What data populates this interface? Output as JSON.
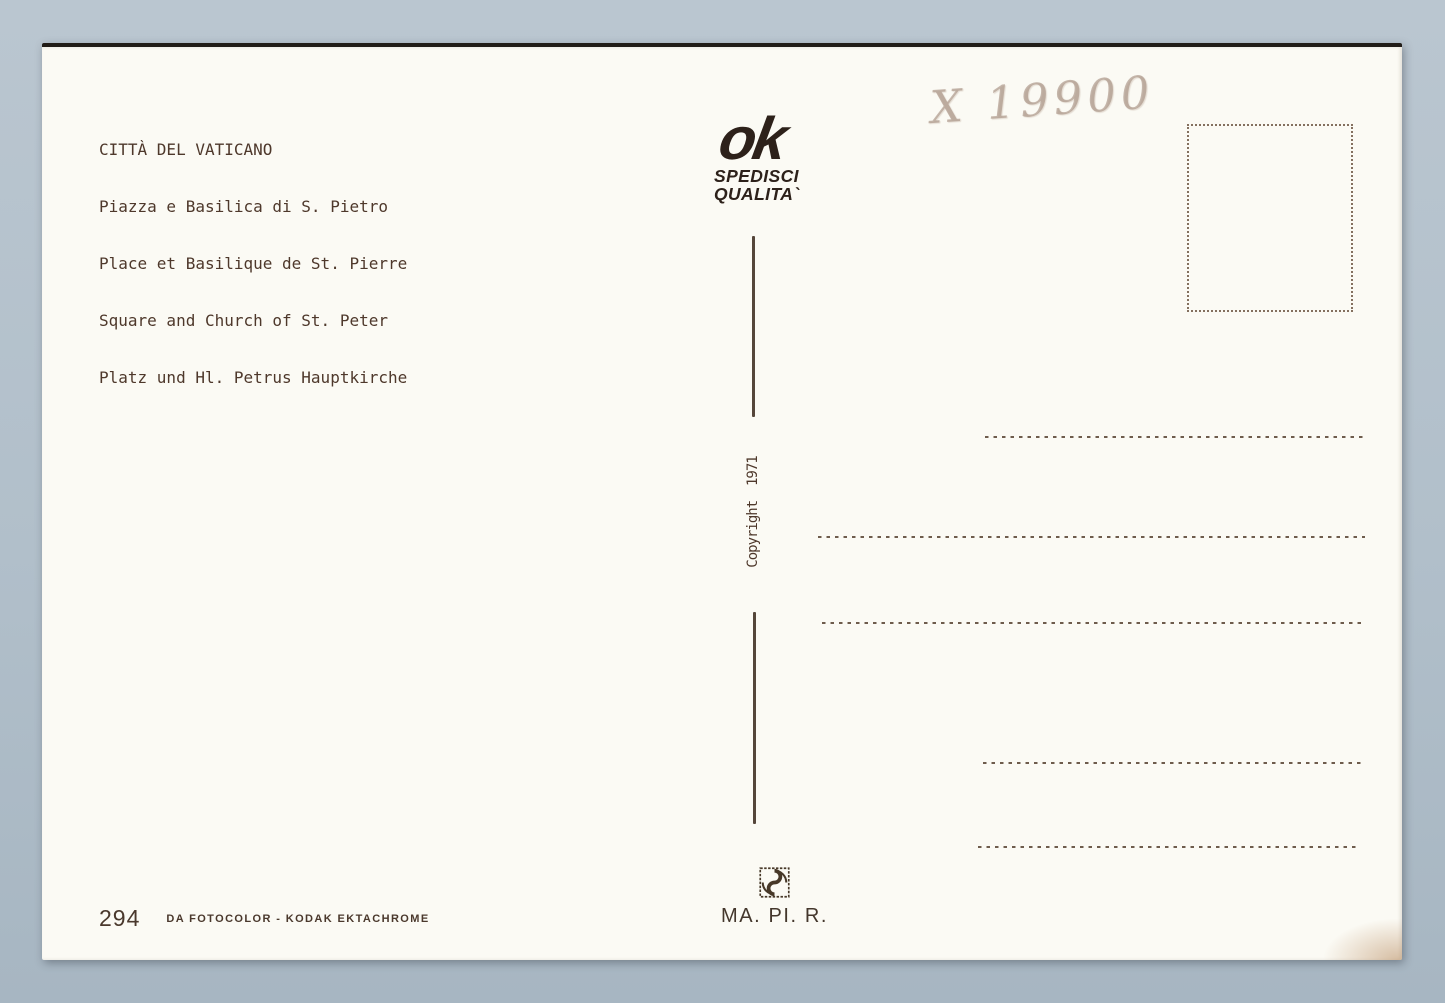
{
  "scan": {
    "background_color": "#b1bfca",
    "card_color": "#fbfaf4",
    "ink_color": "#4e382b",
    "logo_ink_color": "#2d211a",
    "pencil_color": "#a48e80",
    "dotted_line_color": "#6e5c4c"
  },
  "caption": {
    "lines": [
      "CITTÀ DEL VATICANO",
      "Piazza e Basilica di S. Pietro",
      "Place et Basilique de St. Pierre",
      "Square and Church of St. Peter",
      "Platz und Hl. Petrus Hauptkirche"
    ]
  },
  "publisher": {
    "logo_text": "ok",
    "tagline_line1": "SPEDISCI",
    "tagline_line2": "QUALITA`"
  },
  "handwriting": {
    "text": "X 19900"
  },
  "copyright": {
    "text": "Copyright  1971"
  },
  "printer": {
    "brand": "MA. PI. R."
  },
  "credits": {
    "number": "294",
    "film": "DA FOTOCOLOR - KODAK EKTACHROME"
  }
}
